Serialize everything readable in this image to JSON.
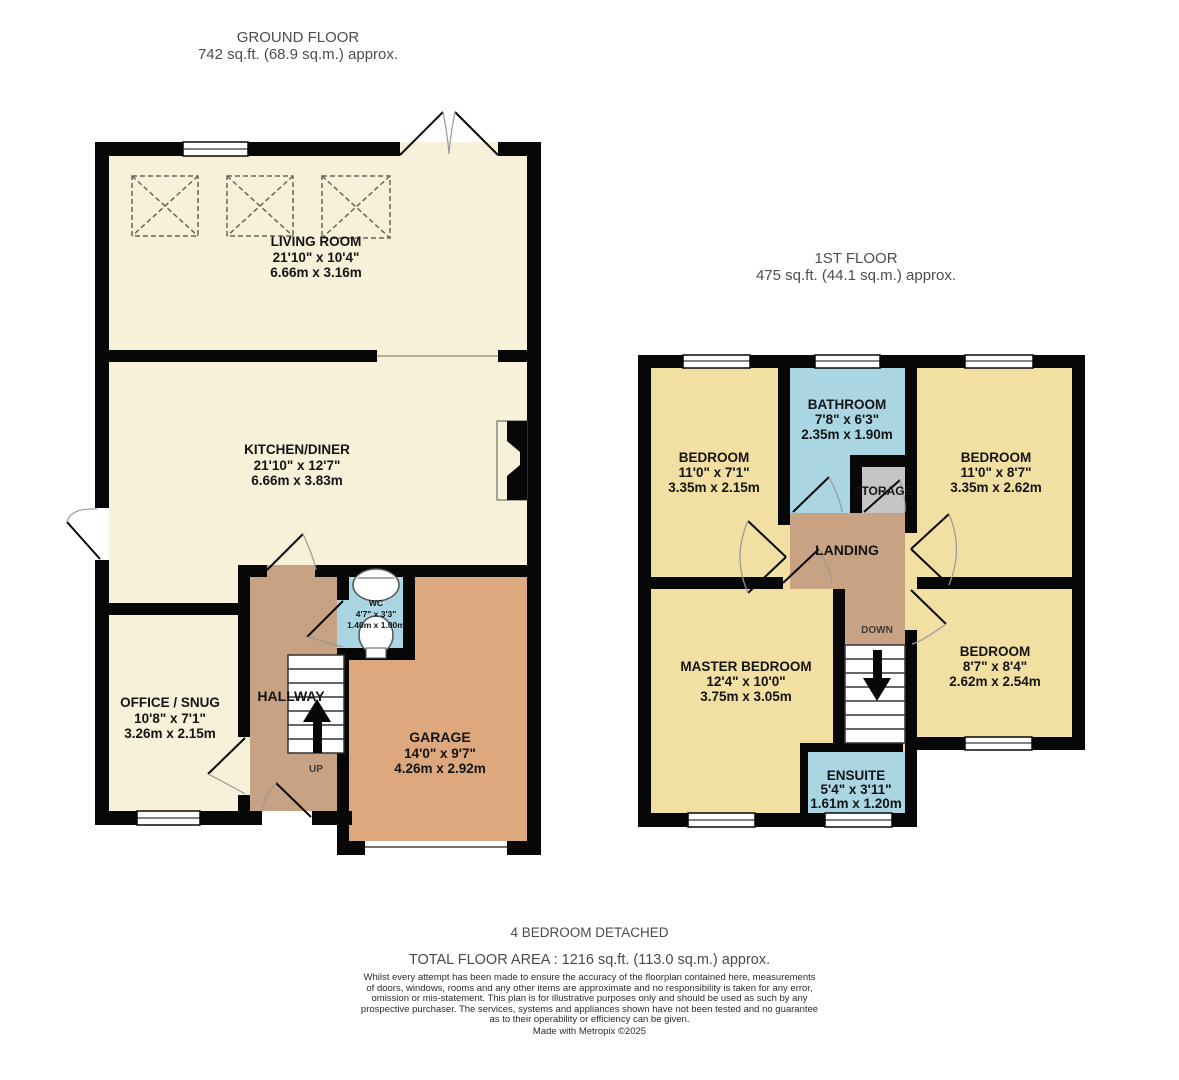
{
  "ground_floor": {
    "title": "GROUND FLOOR",
    "area": "742 sq.ft. (68.9 sq.m.) approx.",
    "rooms": {
      "living_room": {
        "name": "LIVING ROOM",
        "imperial": "21'10\" x 10'4\"",
        "metric": "6.66m x 3.16m"
      },
      "kitchen_diner": {
        "name": "KITCHEN/DINER",
        "imperial": "21'10\" x 12'7\"",
        "metric": "6.66m x 3.83m"
      },
      "office_snug": {
        "name": "OFFICE / SNUG",
        "imperial": "10'8\" x 7'1\"",
        "metric": "3.26m x 2.15m"
      },
      "hallway": {
        "name": "HALLWAY"
      },
      "wc": {
        "name": "WC",
        "imperial": "4'7\" x 3'3\"",
        "metric": "1.40m x 1.00m"
      },
      "garage": {
        "name": "GARAGE",
        "imperial": "14'0\" x 9'7\"",
        "metric": "4.26m x 2.92m"
      },
      "stairs_direction": "UP"
    }
  },
  "first_floor": {
    "title": "1ST FLOOR",
    "area": "475 sq.ft. (44.1 sq.m.) approx.",
    "rooms": {
      "bedroom_top_left": {
        "name": "BEDROOM",
        "imperial": "11'0\" x 7'1\"",
        "metric": "3.35m x 2.15m"
      },
      "bathroom": {
        "name": "BATHROOM",
        "imperial": "7'8\" x 6'3\"",
        "metric": "2.35m x 1.90m"
      },
      "storage": {
        "name": "STORAGE"
      },
      "bedroom_top_right": {
        "name": "BEDROOM",
        "imperial": "11'0\" x 8'7\"",
        "metric": "3.35m x 2.62m"
      },
      "landing": {
        "name": "LANDING"
      },
      "master_bedroom": {
        "name": "MASTER BEDROOM",
        "imperial": "12'4\" x 10'0\"",
        "metric": "3.75m x 3.05m"
      },
      "bedroom_bottom_right": {
        "name": "BEDROOM",
        "imperial": "8'7\" x 8'4\"",
        "metric": "2.62m x 2.54m"
      },
      "ensuite": {
        "name": "ENSUITE",
        "imperial": "5'4\" x 3'11\"",
        "metric": "1.61m x 1.20m"
      },
      "stairs_direction": "DOWN"
    }
  },
  "footer": {
    "property_type": "4 BEDROOM DETACHED",
    "total_area": "TOTAL FLOOR AREA : 1216 sq.ft. (113.0 sq.m.) approx.",
    "disclaimer_lines": [
      "Whilst every attempt has been made to ensure the accuracy of the floorplan contained here, measurements",
      "of doors, windows, rooms and any other items are approximate and no responsibility is taken for any error,",
      "omission or mis-statement. This plan is for illustrative purposes only and should be used as such by any",
      "prospective purchaser. The services, systems and appliances shown have not been tested and no guarantee",
      "as to their operability or efficiency can be given."
    ],
    "credit": "Made with Metropix ©2025"
  },
  "colors": {
    "wall": "#070707",
    "pale_room": "#f6f1d8",
    "bedroom_yellow": "#f2dfa2",
    "garage_orange": "#dda87d",
    "hall_tan": "#c7a384",
    "wet_room_blue": "#a9d6e2",
    "storage_grey": "#c5c4c6"
  }
}
